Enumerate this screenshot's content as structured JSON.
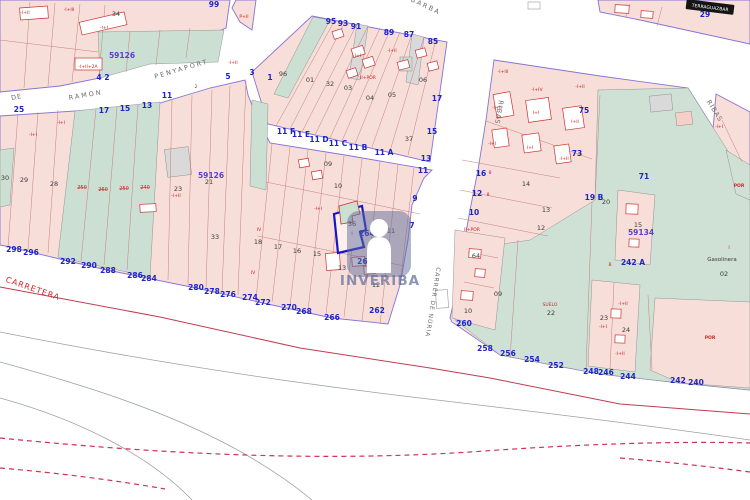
{
  "watermark": {
    "brand": "INVERIBA"
  },
  "selected_parcel": {
    "parcel_number": "36",
    "address_label": "264 B"
  },
  "palette": {
    "parcel_pink": "#f7ded9",
    "parcel_pink_alt": "#f6cfc9",
    "parcel_teal": "#ccdfd3",
    "parcel_gray": "#d9d9d9",
    "boundary_purple": "#8673d6",
    "parcel_line_red": "#c4807d",
    "road_centerline_red": "#c03b52",
    "dashed_red": "#cc3355",
    "selected_parcel_blue": "#1616c8",
    "watermark_slate": "rgba(96,110,155,0.55)",
    "label_colors": {
      "bl": "#1d24c8",
      "bk": "#3a3a3a",
      "rd": "#cc2222",
      "vi": "#5940cf",
      "st": "#6b6b6b",
      "wh": "#ffffff"
    }
  },
  "map_labels": [
    {
      "t": "BARBA",
      "x": 425,
      "y": 8,
      "c": "st",
      "s": 6.5,
      "r": 25,
      "k": 2,
      "n": "street-name-barba"
    },
    {
      "t": "PENYAPORT",
      "x": 182,
      "y": 71,
      "c": "st",
      "s": 6.5,
      "r": -16,
      "k": 2,
      "n": "street-name-penyaport"
    },
    {
      "t": "DE",
      "x": 17,
      "y": 99,
      "c": "st",
      "s": 6.5,
      "r": -10,
      "k": 1,
      "n": "street-name-de-ramon"
    },
    {
      "t": "RAMON",
      "x": 86,
      "y": 97,
      "c": "st",
      "s": 6.5,
      "r": -10,
      "k": 2,
      "n": "street-name-de-ramon"
    },
    {
      "t": "RIBAS",
      "x": 497,
      "y": 112,
      "c": "st",
      "s": 6.5,
      "r": 100,
      "k": 1,
      "n": "street-name-ribas"
    },
    {
      "t": "RIBAS",
      "x": 713,
      "y": 112,
      "c": "st",
      "s": 6.5,
      "r": 58,
      "k": 1,
      "n": "street-name-ribas"
    },
    {
      "t": "CARRER DE NÚRIA",
      "x": 431,
      "y": 302,
      "c": "st",
      "s": 6,
      "r": 99,
      "k": 1,
      "n": "street-name-carrer-de-nuria"
    },
    {
      "t": "CARRETERA",
      "x": 32,
      "y": 291,
      "c": "rd",
      "s": 8,
      "r": 19,
      "k": 1,
      "n": "street-name-carretera"
    },
    {
      "t": "TERRAGUAZBAR",
      "x": 710,
      "y": 9,
      "c": "wh",
      "s": 4.5,
      "r": 7,
      "n": "street-sign-terraguazbar"
    },
    {
      "t": "99",
      "x": 214,
      "y": 7,
      "c": "bl"
    },
    {
      "t": "4",
      "x": 99,
      "y": 80,
      "c": "bl"
    },
    {
      "t": "2",
      "x": 107,
      "y": 80,
      "c": "bl"
    },
    {
      "t": "25",
      "x": 19,
      "y": 112,
      "c": "bl"
    },
    {
      "t": "17",
      "x": 104,
      "y": 113,
      "c": "bl"
    },
    {
      "t": "15",
      "x": 125,
      "y": 111,
      "c": "bl"
    },
    {
      "t": "13",
      "x": 147,
      "y": 108,
      "c": "bl"
    },
    {
      "t": "11",
      "x": 167,
      "y": 98,
      "c": "bl"
    },
    {
      "t": "5",
      "x": 228,
      "y": 79,
      "c": "bl"
    },
    {
      "t": "3",
      "x": 252,
      "y": 75,
      "c": "bl"
    },
    {
      "t": "1",
      "x": 270,
      "y": 80,
      "c": "bl"
    },
    {
      "t": "95",
      "x": 331,
      "y": 24,
      "c": "bl"
    },
    {
      "t": "93",
      "x": 343,
      "y": 26,
      "c": "bl"
    },
    {
      "t": "91",
      "x": 356,
      "y": 29,
      "c": "bl"
    },
    {
      "t": "89",
      "x": 389,
      "y": 35,
      "c": "bl"
    },
    {
      "t": "87",
      "x": 409,
      "y": 37,
      "c": "bl"
    },
    {
      "t": "85",
      "x": 433,
      "y": 44,
      "c": "bl"
    },
    {
      "t": "11 F",
      "x": 286,
      "y": 134,
      "c": "bl"
    },
    {
      "t": "11 E",
      "x": 301,
      "y": 137,
      "c": "bl"
    },
    {
      "t": "11 D",
      "x": 319,
      "y": 142,
      "c": "bl"
    },
    {
      "t": "11 C",
      "x": 338,
      "y": 146,
      "c": "bl"
    },
    {
      "t": "11 B",
      "x": 358,
      "y": 150,
      "c": "bl"
    },
    {
      "t": "11 A",
      "x": 384,
      "y": 155,
      "c": "bl"
    },
    {
      "t": "17",
      "x": 437,
      "y": 101,
      "c": "bl"
    },
    {
      "t": "15",
      "x": 432,
      "y": 134,
      "c": "bl"
    },
    {
      "t": "13",
      "x": 426,
      "y": 161,
      "c": "bl"
    },
    {
      "t": "11",
      "x": 423,
      "y": 173,
      "c": "bl"
    },
    {
      "t": "9",
      "x": 415,
      "y": 201,
      "c": "bl"
    },
    {
      "t": "7",
      "x": 412,
      "y": 228,
      "c": "bl"
    },
    {
      "t": "264 B",
      "x": 371,
      "y": 236,
      "c": "bl",
      "n": "selected-parcel-address"
    },
    {
      "t": "264",
      "x": 365,
      "y": 264,
      "c": "bl"
    },
    {
      "t": "262",
      "x": 377,
      "y": 313,
      "c": "bl"
    },
    {
      "t": "298",
      "x": 14,
      "y": 252,
      "c": "bl"
    },
    {
      "t": "296",
      "x": 31,
      "y": 255,
      "c": "bl"
    },
    {
      "t": "292",
      "x": 68,
      "y": 264,
      "c": "bl"
    },
    {
      "t": "290",
      "x": 89,
      "y": 268,
      "c": "bl"
    },
    {
      "t": "288",
      "x": 108,
      "y": 273,
      "c": "bl"
    },
    {
      "t": "286",
      "x": 135,
      "y": 278,
      "c": "bl"
    },
    {
      "t": "284",
      "x": 149,
      "y": 281,
      "c": "bl"
    },
    {
      "t": "280",
      "x": 196,
      "y": 290,
      "c": "bl"
    },
    {
      "t": "278",
      "x": 212,
      "y": 294,
      "c": "bl"
    },
    {
      "t": "276",
      "x": 228,
      "y": 297,
      "c": "bl"
    },
    {
      "t": "274",
      "x": 250,
      "y": 300,
      "c": "bl"
    },
    {
      "t": "272",
      "x": 263,
      "y": 305,
      "c": "bl"
    },
    {
      "t": "270",
      "x": 289,
      "y": 310,
      "c": "bl"
    },
    {
      "t": "268",
      "x": 304,
      "y": 314,
      "c": "bl"
    },
    {
      "t": "266",
      "x": 332,
      "y": 320,
      "c": "bl"
    },
    {
      "t": "16",
      "x": 481,
      "y": 176,
      "c": "bl"
    },
    {
      "t": "12",
      "x": 477,
      "y": 196,
      "c": "bl"
    },
    {
      "t": "10",
      "x": 474,
      "y": 215,
      "c": "bl"
    },
    {
      "t": "260",
      "x": 464,
      "y": 326,
      "c": "bl"
    },
    {
      "t": "258",
      "x": 485,
      "y": 351,
      "c": "bl"
    },
    {
      "t": "256",
      "x": 508,
      "y": 356,
      "c": "bl"
    },
    {
      "t": "254",
      "x": 532,
      "y": 362,
      "c": "bl"
    },
    {
      "t": "252",
      "x": 556,
      "y": 368,
      "c": "bl"
    },
    {
      "t": "248",
      "x": 591,
      "y": 374,
      "c": "bl"
    },
    {
      "t": "246",
      "x": 606,
      "y": 375,
      "c": "bl"
    },
    {
      "t": "244",
      "x": 628,
      "y": 379,
      "c": "bl"
    },
    {
      "t": "242",
      "x": 678,
      "y": 383,
      "c": "bl"
    },
    {
      "t": "240",
      "x": 696,
      "y": 385,
      "c": "bl"
    },
    {
      "t": "242 A",
      "x": 633,
      "y": 265,
      "c": "bl"
    },
    {
      "t": "19 B",
      "x": 594,
      "y": 200,
      "c": "bl"
    },
    {
      "t": "71",
      "x": 644,
      "y": 179,
      "c": "bl"
    },
    {
      "t": "75",
      "x": 584,
      "y": 113,
      "c": "bl"
    },
    {
      "t": "73",
      "x": 577,
      "y": 156,
      "c": "bl"
    },
    {
      "t": "29",
      "x": 705,
      "y": 17,
      "c": "bl"
    },
    {
      "t": "59126",
      "x": 122,
      "y": 58,
      "c": "vi",
      "n": "block-code"
    },
    {
      "t": "59126",
      "x": 211,
      "y": 178,
      "c": "vi",
      "n": "block-code"
    },
    {
      "t": "59134",
      "x": 641,
      "y": 235,
      "c": "vi",
      "n": "block-code"
    },
    {
      "t": "34",
      "x": 116,
      "y": 16,
      "c": "bk"
    },
    {
      "t": "30",
      "x": 5,
      "y": 180,
      "c": "bk"
    },
    {
      "t": "29",
      "x": 24,
      "y": 182,
      "c": "bk"
    },
    {
      "t": "28",
      "x": 54,
      "y": 186,
      "c": "bk"
    },
    {
      "t": "23",
      "x": 178,
      "y": 191,
      "c": "bk"
    },
    {
      "t": "21",
      "x": 209,
      "y": 184,
      "c": "bk"
    },
    {
      "t": "96",
      "x": 283,
      "y": 76,
      "c": "bk"
    },
    {
      "t": "01",
      "x": 310,
      "y": 82,
      "c": "bk"
    },
    {
      "t": "32",
      "x": 330,
      "y": 86,
      "c": "bk"
    },
    {
      "t": "03",
      "x": 348,
      "y": 90,
      "c": "bk"
    },
    {
      "t": "04",
      "x": 370,
      "y": 100,
      "c": "bk"
    },
    {
      "t": "05",
      "x": 392,
      "y": 97,
      "c": "bk"
    },
    {
      "t": "06",
      "x": 423,
      "y": 82,
      "c": "bk"
    },
    {
      "t": "37",
      "x": 409,
      "y": 141,
      "c": "bk"
    },
    {
      "t": "09",
      "x": 328,
      "y": 166,
      "c": "bk"
    },
    {
      "t": "10",
      "x": 338,
      "y": 188,
      "c": "bk"
    },
    {
      "t": "15",
      "x": 317,
      "y": 256,
      "c": "bk"
    },
    {
      "t": "13",
      "x": 342,
      "y": 270,
      "c": "bk"
    },
    {
      "t": "12",
      "x": 376,
      "y": 287,
      "c": "bk"
    },
    {
      "t": "36",
      "x": 352,
      "y": 226,
      "c": "bk",
      "n": "selected-parcel-number"
    },
    {
      "t": "11",
      "x": 391,
      "y": 233,
      "c": "bk"
    },
    {
      "t": "33",
      "x": 215,
      "y": 239,
      "c": "bk"
    },
    {
      "t": "18",
      "x": 258,
      "y": 244,
      "c": "bk"
    },
    {
      "t": "17",
      "x": 278,
      "y": 249,
      "c": "bk"
    },
    {
      "t": "16",
      "x": 297,
      "y": 253,
      "c": "bk"
    },
    {
      "t": "14",
      "x": 526,
      "y": 186,
      "c": "bk"
    },
    {
      "t": "13",
      "x": 546,
      "y": 212,
      "c": "bk"
    },
    {
      "t": "12",
      "x": 541,
      "y": 230,
      "c": "bk"
    },
    {
      "t": "20",
      "x": 606,
      "y": 204,
      "c": "bk"
    },
    {
      "t": "15",
      "x": 638,
      "y": 227,
      "c": "bk"
    },
    {
      "t": "23",
      "x": 604,
      "y": 320,
      "c": "bk"
    },
    {
      "t": "24",
      "x": 626,
      "y": 332,
      "c": "bk"
    },
    {
      "t": "22",
      "x": 551,
      "y": 315,
      "c": "bk"
    },
    {
      "t": "02",
      "x": 724,
      "y": 276,
      "c": "bk"
    },
    {
      "t": "64",
      "x": 476,
      "y": 258,
      "c": "bk"
    },
    {
      "t": "09",
      "x": 498,
      "y": 296,
      "c": "bk"
    },
    {
      "t": "10",
      "x": 468,
      "y": 313,
      "c": "bk"
    },
    {
      "t": "Gasolinera",
      "x": 722,
      "y": 261,
      "c": "bk",
      "s": 5.5,
      "n": "poi-gasolinera"
    },
    {
      "t": "-I+II",
      "x": 25,
      "y": 14,
      "c": "rd"
    },
    {
      "t": "-I+III",
      "x": 69,
      "y": 11,
      "c": "rd"
    },
    {
      "t": "-I+I",
      "x": 104,
      "y": 29,
      "c": "rd"
    },
    {
      "t": "-I+II+2A",
      "x": 88,
      "y": 68,
      "c": "rd"
    },
    {
      "t": "-I+I",
      "x": 61,
      "y": 124,
      "c": "rd"
    },
    {
      "t": "-I+I",
      "x": 33,
      "y": 136,
      "c": "rd"
    },
    {
      "t": "2",
      "x": 196,
      "y": 88,
      "c": "rd"
    },
    {
      "t": "-I+II",
      "x": 233,
      "y": 64,
      "c": "rd"
    },
    {
      "t": "P+II",
      "x": 244,
      "y": 18,
      "c": "rd"
    },
    {
      "t": "II+POR",
      "x": 368,
      "y": 79,
      "c": "rd"
    },
    {
      "t": "I+I",
      "x": 358,
      "y": 57,
      "c": "rd"
    },
    {
      "t": "-I+II",
      "x": 392,
      "y": 52,
      "c": "rd"
    },
    {
      "t": "POR",
      "x": 377,
      "y": 272,
      "c": "rd",
      "w": 700
    },
    {
      "t": "I",
      "x": 352,
      "y": 235,
      "c": "rd"
    },
    {
      "t": "-I+I",
      "x": 318,
      "y": 210,
      "c": "rd"
    },
    {
      "t": "IV",
      "x": 259,
      "y": 231,
      "c": "rd"
    },
    {
      "t": "IV",
      "x": 253,
      "y": 274,
      "c": "rd"
    },
    {
      "t": "-I+II",
      "x": 176,
      "y": 197,
      "c": "rd"
    },
    {
      "t": "-I+III",
      "x": 503,
      "y": 73,
      "c": "rd"
    },
    {
      "t": "-I+IV",
      "x": 537,
      "y": 91,
      "c": "rd"
    },
    {
      "t": "-I+II",
      "x": 580,
      "y": 88,
      "c": "rd"
    },
    {
      "t": "I+I",
      "x": 536,
      "y": 114,
      "c": "rd"
    },
    {
      "t": "-I+II",
      "x": 497,
      "y": 109,
      "c": "rd"
    },
    {
      "t": "I+II",
      "x": 575,
      "y": 123,
      "c": "rd"
    },
    {
      "t": "-I+I",
      "x": 492,
      "y": 145,
      "c": "rd"
    },
    {
      "t": "I+I",
      "x": 530,
      "y": 149,
      "c": "rd"
    },
    {
      "t": "-I+II",
      "x": 564,
      "y": 160,
      "c": "rd"
    },
    {
      "t": "II+POR",
      "x": 472,
      "y": 231,
      "c": "rd"
    },
    {
      "t": "8",
      "x": 490,
      "y": 174,
      "c": "rd"
    },
    {
      "t": "8",
      "x": 488,
      "y": 196,
      "c": "rd"
    },
    {
      "t": "SUELO",
      "x": 550,
      "y": 306,
      "c": "rd"
    },
    {
      "t": "POR",
      "x": 739,
      "y": 187,
      "c": "rd",
      "w": 700
    },
    {
      "t": "POR",
      "x": 710,
      "y": 339,
      "c": "rd",
      "w": 700
    },
    {
      "t": "-I+I",
      "x": 719,
      "y": 128,
      "c": "rd"
    },
    {
      "t": "B",
      "x": 610,
      "y": 266,
      "c": "rd"
    },
    {
      "t": "I",
      "x": 729,
      "y": 249,
      "c": "rd"
    },
    {
      "t": "-I+II",
      "x": 623,
      "y": 305,
      "c": "rd"
    },
    {
      "t": "-I+I",
      "x": 603,
      "y": 328,
      "c": "rd"
    },
    {
      "t": "-I+II",
      "x": 620,
      "y": 355,
      "c": "rd"
    },
    {
      "t": "250",
      "x": 82,
      "y": 189,
      "c": "rd",
      "s": 5,
      "st": 1
    },
    {
      "t": "260",
      "x": 103,
      "y": 191,
      "c": "rd",
      "s": 5,
      "st": 1
    },
    {
      "t": "250",
      "x": 124,
      "y": 190,
      "c": "rd",
      "s": 5,
      "st": 1
    },
    {
      "t": "240",
      "x": 145,
      "y": 189,
      "c": "rd",
      "s": 5,
      "st": 1
    }
  ]
}
